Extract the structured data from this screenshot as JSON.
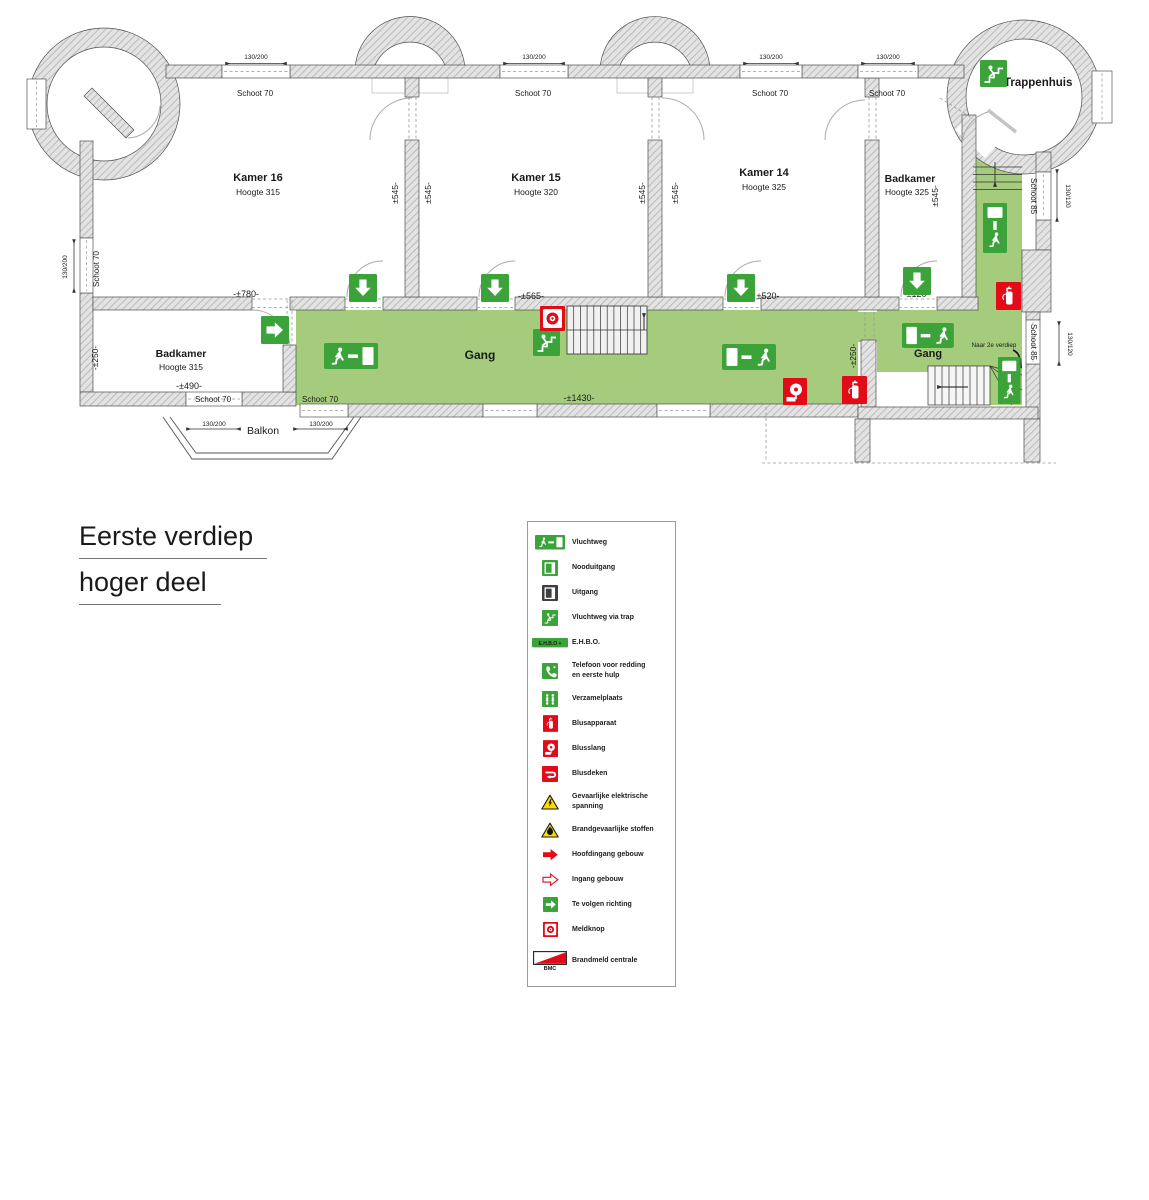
{
  "title": {
    "line1": "Eerste verdiep",
    "line2": "hoger deel"
  },
  "colors": {
    "route_green": "#a4cc7c",
    "sign_green": "#3ba33a",
    "alarm_red": "#e30b17",
    "warning_yellow": "#ffd800"
  },
  "plan": {
    "rooms": {
      "kamer16": {
        "name": "Kamer 16",
        "height": "Hoogte 315"
      },
      "kamer15": {
        "name": "Kamer 15",
        "height": "Hoogte 320"
      },
      "kamer14": {
        "name": "Kamer 14",
        "height": "Hoogte 325"
      },
      "badkamer_boven": {
        "name": "Badkamer",
        "height": "Hoogte 325"
      },
      "badkamer_onder": {
        "name": "Badkamer",
        "height": "Hoogte 315"
      }
    },
    "areas": {
      "gang": "Gang",
      "trappenhuis": "Trappenhuis",
      "balkon": "Balkon"
    },
    "annotations": {
      "naar_2e_verdiep": "Naar 2e verdiep"
    },
    "openings": {
      "schoot70": "Schoot 70",
      "schoot85": "Schoot 85",
      "maat130_200": "130/200",
      "maat130_120": "130/120"
    },
    "dimensions": {
      "d780": "-±780-",
      "d565": "-±565-",
      "d520": "±520-",
      "d490": "-±490-",
      "d1430": "-±1430-",
      "d250": "-±250-",
      "d545": "±545-",
      "d120": "±120-"
    }
  },
  "legend": {
    "items": [
      {
        "label": "Vluchtweg"
      },
      {
        "label": "Nooduitgang"
      },
      {
        "label": "Uitgang"
      },
      {
        "label": "Vluchtweg via trap"
      },
      {
        "label": "E.H.B.O.",
        "icon_text": "E.H.B.O +"
      },
      {
        "label": "Telefoon voor redding",
        "label2": "en eerste hulp"
      },
      {
        "label": "Verzamelplaats"
      },
      {
        "label": "Blusapparaat"
      },
      {
        "label": "Blusslang"
      },
      {
        "label": "Blusdeken"
      },
      {
        "label": "Gevaarlijke elektrische",
        "label2": "spanning"
      },
      {
        "label": "Brandgevaarlijke stoffen"
      },
      {
        "label": "Hoofdingang gebouw"
      },
      {
        "label": "Ingang gebouw"
      },
      {
        "label": "Te volgen richting"
      },
      {
        "label": "Meldknop"
      },
      {
        "label": "Brandmeld centrale",
        "sub": "BMC"
      }
    ]
  }
}
